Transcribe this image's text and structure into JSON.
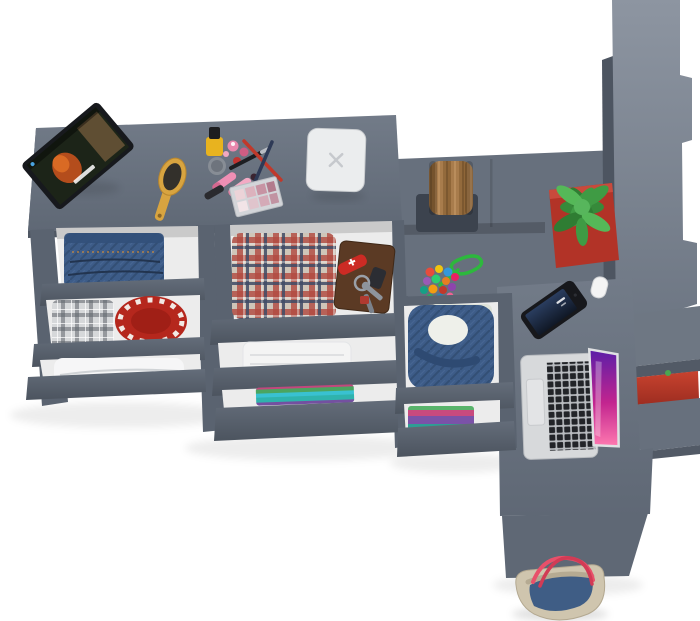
{
  "scene": {
    "title": "Top-down 3D render of a gray modular furniture set with open drawers, desk and wardrobe",
    "background": "#ffffff"
  },
  "colors": {
    "bg": "#ffffff",
    "furniture": "#67707d",
    "furniture-dark": "#525a66",
    "furniture-light": "#8d95a1",
    "drawer-front": "#5a6370",
    "drawer-interior": "#ececec",
    "plate-red": "#b5271d",
    "pot-red": "#b23327",
    "accent-red": "#b5382c",
    "plant-green": "#3f9b44",
    "wood-brown": "#a87c4c",
    "denim-blue": "#3d5c88",
    "laptop-silver": "#d7d9db",
    "laptop-keys": "#222428",
    "screen-magenta": "#c2258f",
    "bag-khaki": "#cfc5ae",
    "strap-red": "#e8506a"
  },
  "items": {
    "desk": "Dressing table top",
    "tablet": "Tablet playing a movie",
    "hairbrush": "Hairbrush",
    "cosmetics": "Makeup set with nail polish, lipsticks, pencils and eyeshadow palette",
    "white_box": "White box",
    "jeans": "Folded jeans in open drawer",
    "plaid_shirt": "Folded gray plaid shirt",
    "red_plate": "Red decorative plate",
    "blanket": "Folded blanket",
    "plaid_shorts": "Folded red plaid clothes",
    "wallet": "Brown leather wallet",
    "knife": "Red pocket knife",
    "keys": "Key set with ring",
    "towel": "Folded white towel",
    "color_stack": "Stack of colorful folded clothes",
    "stool": "Wooden stool",
    "pompoms": "Multicolor pompom garland with green cord",
    "plant": "Succulent in red planter",
    "denim_jacket": "Denim jacket in open drawer",
    "clothes_stack": "Folded purple and teal clothes",
    "smartphone": "Smartphone",
    "laptop": "Open silver laptop",
    "wardrobe": "Tall wardrobe with stepped shelves",
    "red_box": "Red shelf box",
    "bag": "Denim tote bag with red straps"
  }
}
